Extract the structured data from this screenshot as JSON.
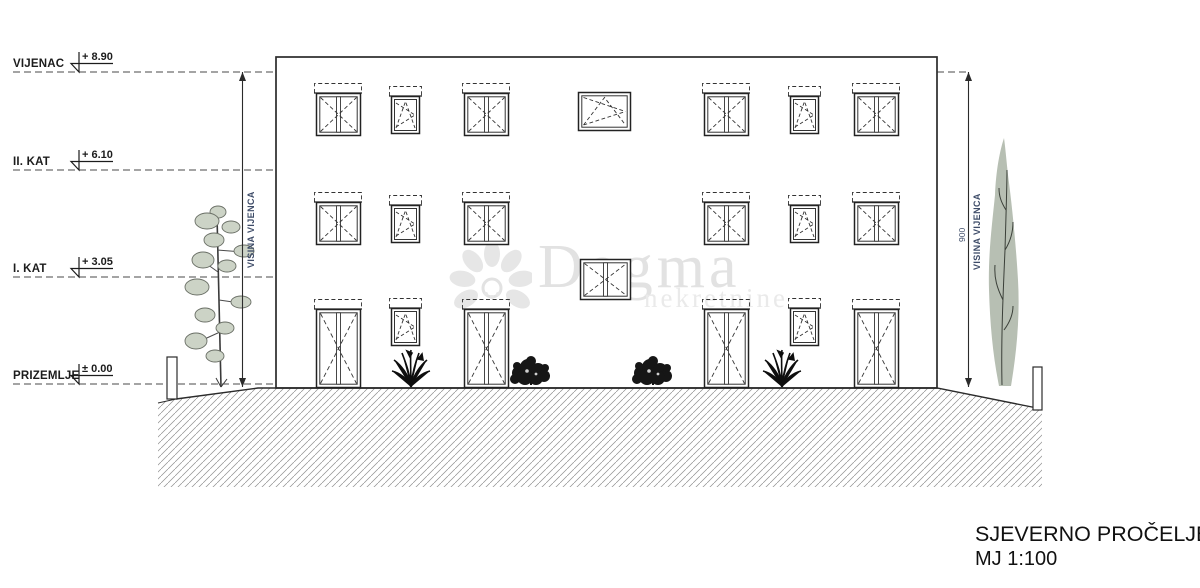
{
  "drawing_title": {
    "title": "SJEVERNO PROČELJE",
    "scale": "MJ 1:100"
  },
  "levels": [
    {
      "name": "VIJENAC",
      "elevation": "+ 8.90"
    },
    {
      "name": "II. KAT",
      "elevation": "+ 6.10"
    },
    {
      "name": "I. KAT",
      "elevation": "+ 3.05"
    },
    {
      "name": "PRIZEMLJE",
      "elevation": "± 0.00"
    }
  ],
  "dimension_annotations": {
    "left_vertical_label": "VISINA VIJENCA",
    "right_vertical_label": "VISINA VIJENCA",
    "right_dimension_value": "900"
  },
  "watermark": {
    "brand": "Dogma",
    "subtext": "nekretnine"
  },
  "colors": {
    "line": "#2b2b2b",
    "annotation_text": "#3e4c68",
    "foliage": "#ccd3c6",
    "cypress": "#b7bfb3",
    "watermark": "#e2e2e2",
    "hatch": "#8f8f8f"
  }
}
